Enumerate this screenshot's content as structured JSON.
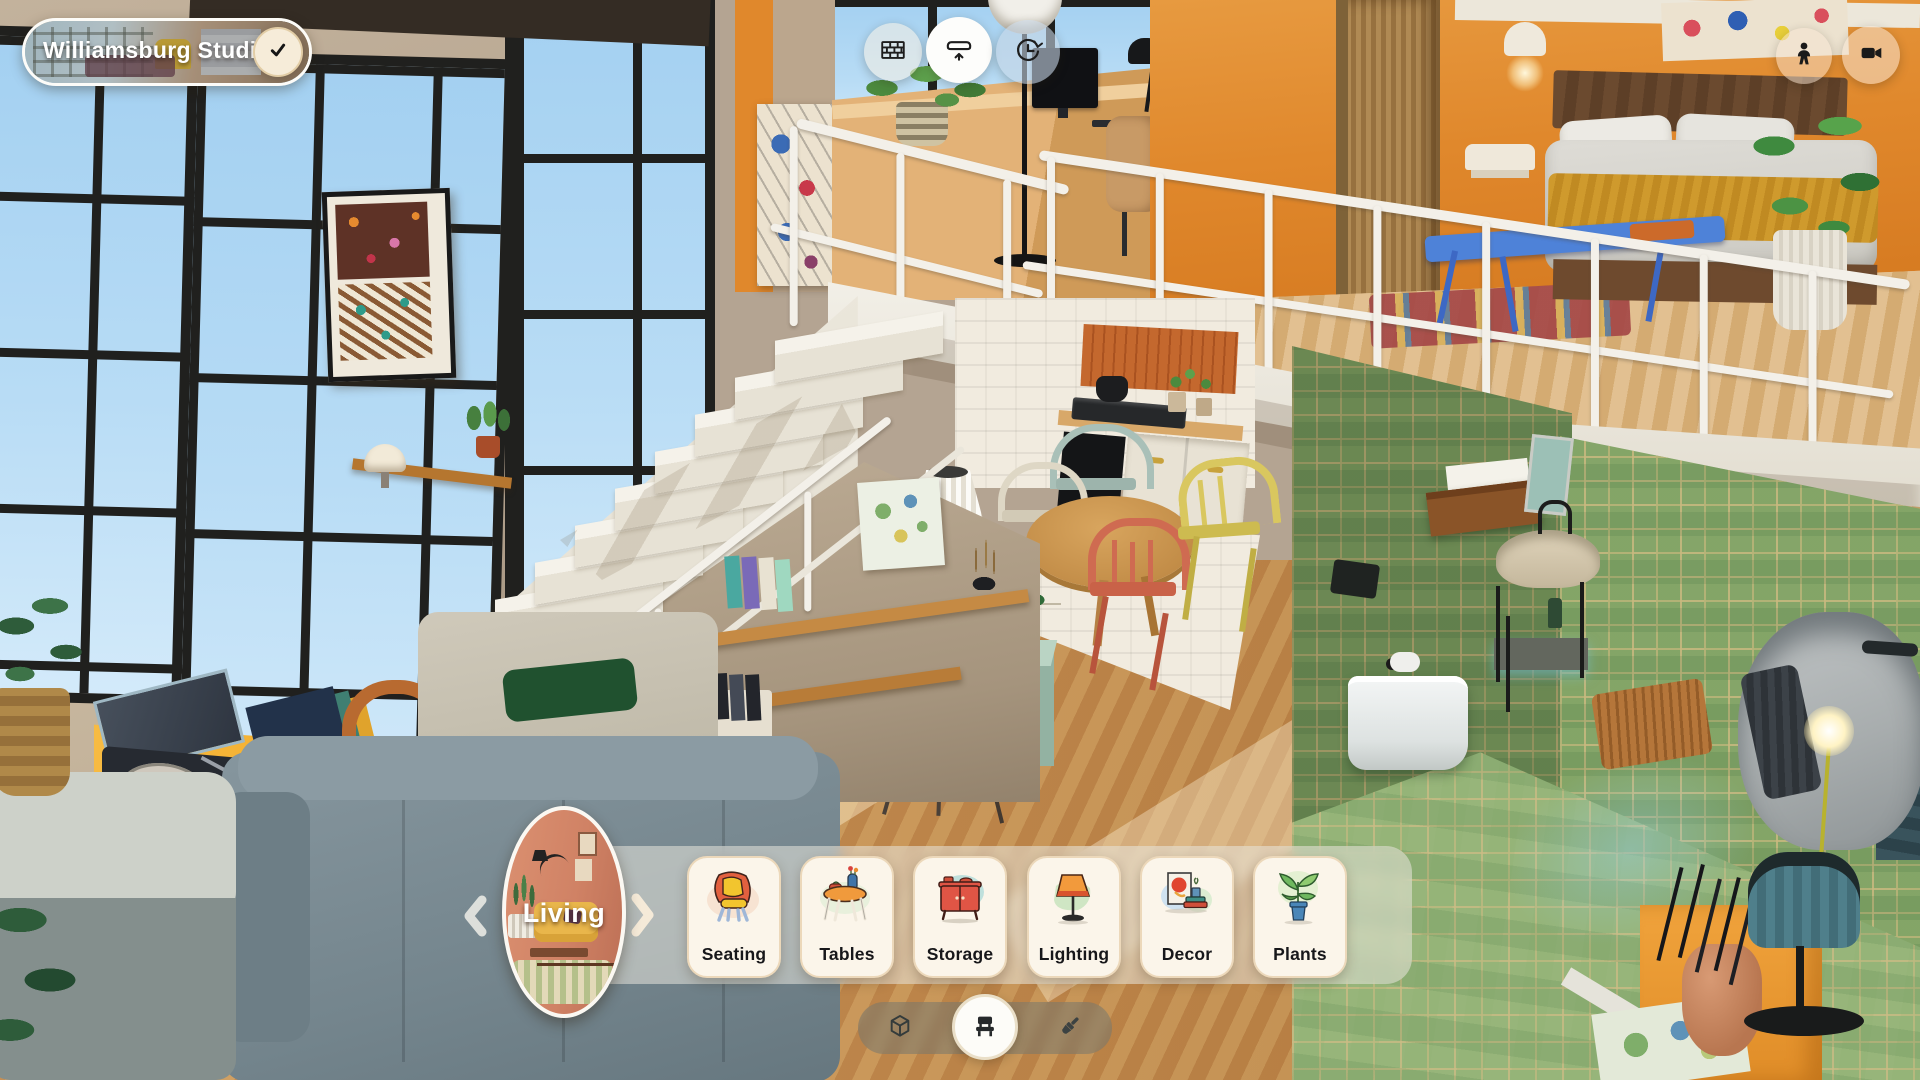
{
  "header": {
    "project_pill": {
      "title": "Williamsburg Studio",
      "confirm_icon": "checkmark"
    },
    "scene_tools": [
      {
        "id": "walls",
        "icon": "brick-wall-icon",
        "active": false
      },
      {
        "id": "floors",
        "icon": "floor-raise-icon",
        "active": true
      },
      {
        "id": "history",
        "icon": "clock-rotate-icon",
        "active": false
      }
    ],
    "camera_tools": [
      {
        "id": "person-view",
        "icon": "person-icon"
      },
      {
        "id": "record-view",
        "icon": "video-camera-icon"
      }
    ]
  },
  "category_carousel": {
    "room": {
      "label": "Living",
      "thumbnail": "living-room-illustration"
    },
    "nav_left_icon": "chevron-left",
    "nav_right_icon": "chevron-right",
    "categories": [
      {
        "label": "Seating",
        "icon": "armchair-illustration"
      },
      {
        "label": "Tables",
        "icon": "round-table-illustration"
      },
      {
        "label": "Storage",
        "icon": "sideboard-illustration"
      },
      {
        "label": "Lighting",
        "icon": "lamp-illustration"
      },
      {
        "label": "Decor",
        "icon": "art-and-books-illustration"
      },
      {
        "label": "Plants",
        "icon": "potted-plant-illustration"
      }
    ]
  },
  "mode_toolbar": {
    "items": [
      {
        "id": "build",
        "icon": "cube-icon",
        "active": false
      },
      {
        "id": "furnish",
        "icon": "chair-icon",
        "active": true
      },
      {
        "id": "paint",
        "icon": "paintbrush-icon",
        "active": false
      }
    ]
  },
  "colors": {
    "card_bg": "#fbf5ea",
    "card_border": "#ecd8ba",
    "sideboard_orange": "#f2a31f",
    "bedroom_orange": "#e1892e",
    "tile_green": "#85a569",
    "sky_blue": "#aed8f4",
    "accent_white": "#fdfcf8"
  }
}
